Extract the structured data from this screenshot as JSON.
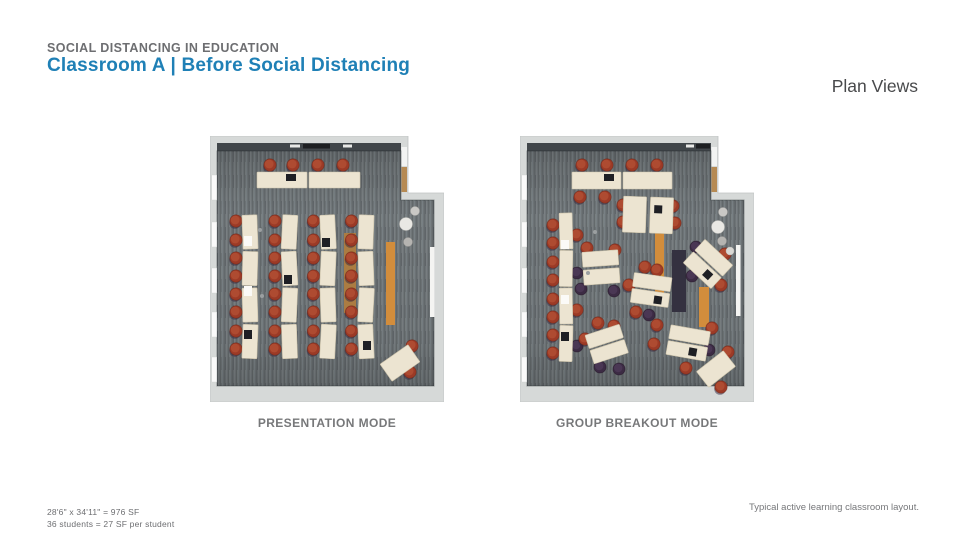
{
  "header": {
    "eyebrow": "SOCIAL DISTANCING IN EDUCATION",
    "title": "Classroom A | Before Social Distancing",
    "corner_label": "Plan Views"
  },
  "plans": [
    {
      "label": "PRESENTATION MODE"
    },
    {
      "label": "GROUP BREAKOUT MODE"
    }
  ],
  "footnotes": {
    "left_line1": "28'6\" x 34'11\" = 976 SF",
    "left_line2": "36 students = 27 SF per student",
    "right": "Typical active learning classroom layout."
  },
  "colors": {
    "title_blue": "#1f80b6",
    "text_gray": "#6d6e71",
    "label_gray": "#77787a",
    "carpet_gray": "#6e7477",
    "wall_gray": "#d6d9d8",
    "top_wall_dark": "#41464a",
    "desk_cream": "#ece4d1",
    "chair_red": "#9c3a26",
    "chair_purple": "#3c2b44",
    "bench_orange": "#d28d3c",
    "bench_tan": "#ab7c42",
    "screen_navy": "#343140"
  }
}
